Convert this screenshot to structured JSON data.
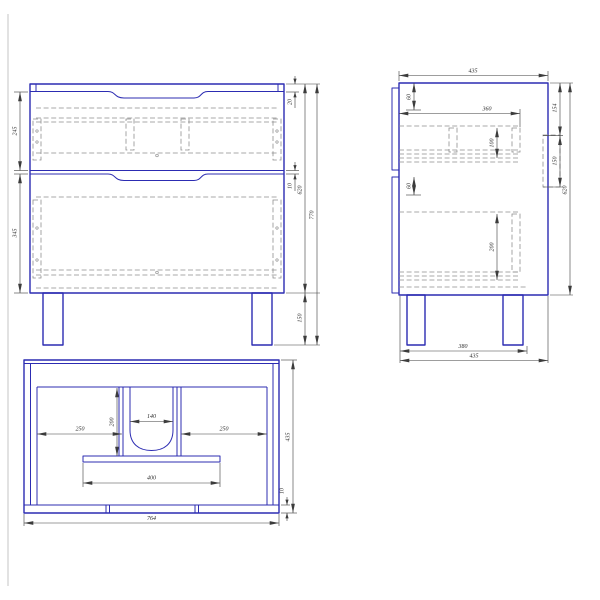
{
  "drawing": {
    "title": "Two-drawer vanity cabinet — orthographic technical drawing",
    "colors": {
      "outline": "#2c2cb2",
      "hidden_line": "#8f8f8f",
      "dimension_line": "#3c3c3c",
      "background": "#ffffff"
    },
    "views": {
      "front": {
        "name": "front view",
        "dims": {
          "drawer_top": "245",
          "drawer_bottom": "345",
          "top_panel": "20",
          "gap": "10",
          "body_height": "620",
          "total_height": "770",
          "leg_height": "150"
        }
      },
      "side": {
        "name": "side view",
        "dims": {
          "depth": "435",
          "offset_top": "60",
          "rail_length": "360",
          "rail_height": "100",
          "offset_mid": "60",
          "lower_rail_height": "200",
          "back_top": "154",
          "back_mid": "150",
          "body_height": "620",
          "leg_span": "380",
          "depth_total": "435"
        }
      },
      "plan": {
        "name": "plan view",
        "dims": {
          "left_bay": "250",
          "bay_depth": "200",
          "cutout_width": "140",
          "right_bay": "250",
          "bracket_width": "400",
          "overall_width": "764",
          "overall_depth": "435",
          "front_lip": "10"
        }
      }
    }
  }
}
